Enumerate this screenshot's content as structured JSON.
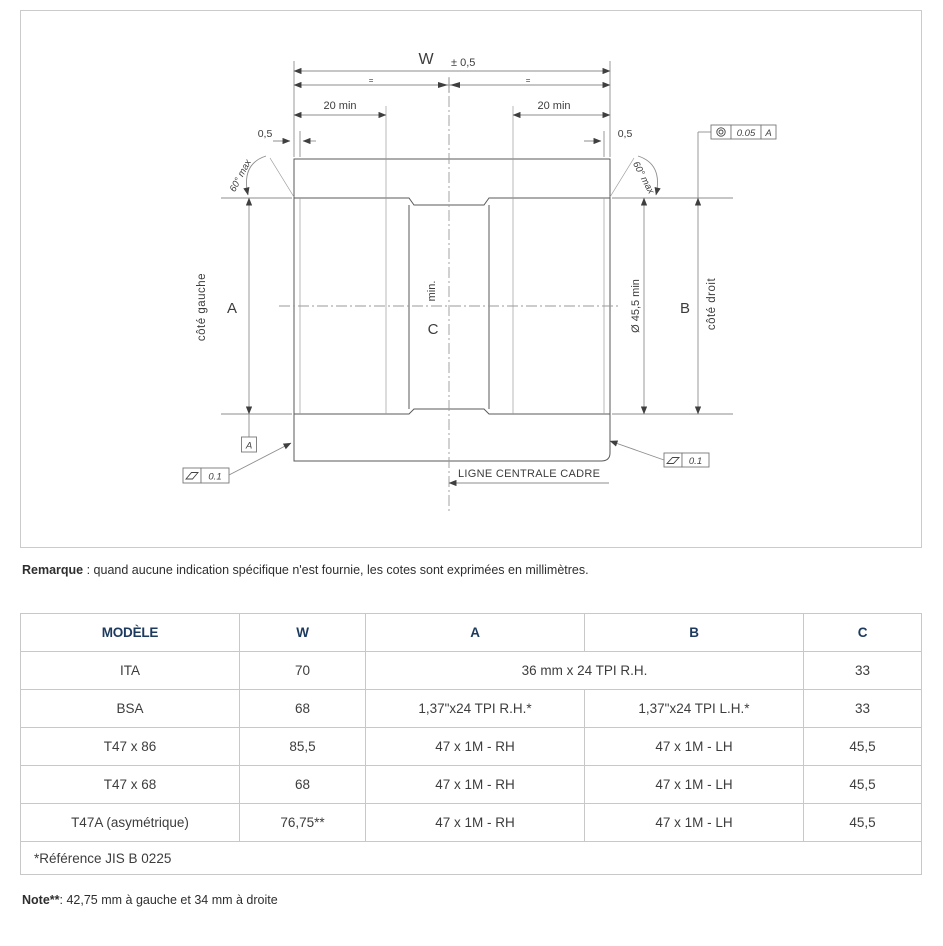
{
  "drawing": {
    "dim_w": "W",
    "dim_w_tol": "± 0,5",
    "equal_mark": "=",
    "dim_20min": "20 min",
    "dim_05": "0,5",
    "angle_max": "60° max",
    "label_side_a": "A",
    "label_side_b": "B",
    "label_center_c": "C",
    "label_min": "min.",
    "side_left": "côté gauche",
    "side_right": "côté droit",
    "dim_bore": "Ø 45,5 min",
    "centerline_label": "LIGNE CENTRALE CADRE",
    "datum_a": "A",
    "flatness_tol": "0.1",
    "concentricity_tol": "0.05"
  },
  "remark": {
    "label": "Remarque",
    "text": " : quand aucune indication spécifique n'est fournie, les cotes sont exprimées en millimètres."
  },
  "table": {
    "headers": [
      "MODÈLE",
      "W",
      "A",
      "B",
      "C"
    ],
    "rows": [
      {
        "model": "ITA",
        "w": "70",
        "a": "36 mm x 24 TPI R.H.",
        "c": "33"
      },
      {
        "model": "BSA",
        "w": "68",
        "a": "1,37\"x24 TPI R.H.*",
        "b": "1,37\"x24 TPI L.H.*",
        "c": "33"
      },
      {
        "model": "T47 x 86",
        "w": "85,5",
        "a": "47 x 1M - RH",
        "b": "47 x 1M - LH",
        "c": "45,5"
      },
      {
        "model": "T47 x 68",
        "w": "68",
        "a": "47 x 1M - RH",
        "b": "47 x 1M - LH",
        "c": "45,5"
      },
      {
        "model": "T47A (asymétrique)",
        "w": "76,75**",
        "a": "47 x 1M - RH",
        "b": "47 x 1M - LH",
        "c": "45,5"
      }
    ],
    "footnote": "*Référence  JIS B 0225"
  },
  "note": {
    "label": "Note**",
    "text": ": 42,75 mm à gauche et 34 mm à droite"
  }
}
